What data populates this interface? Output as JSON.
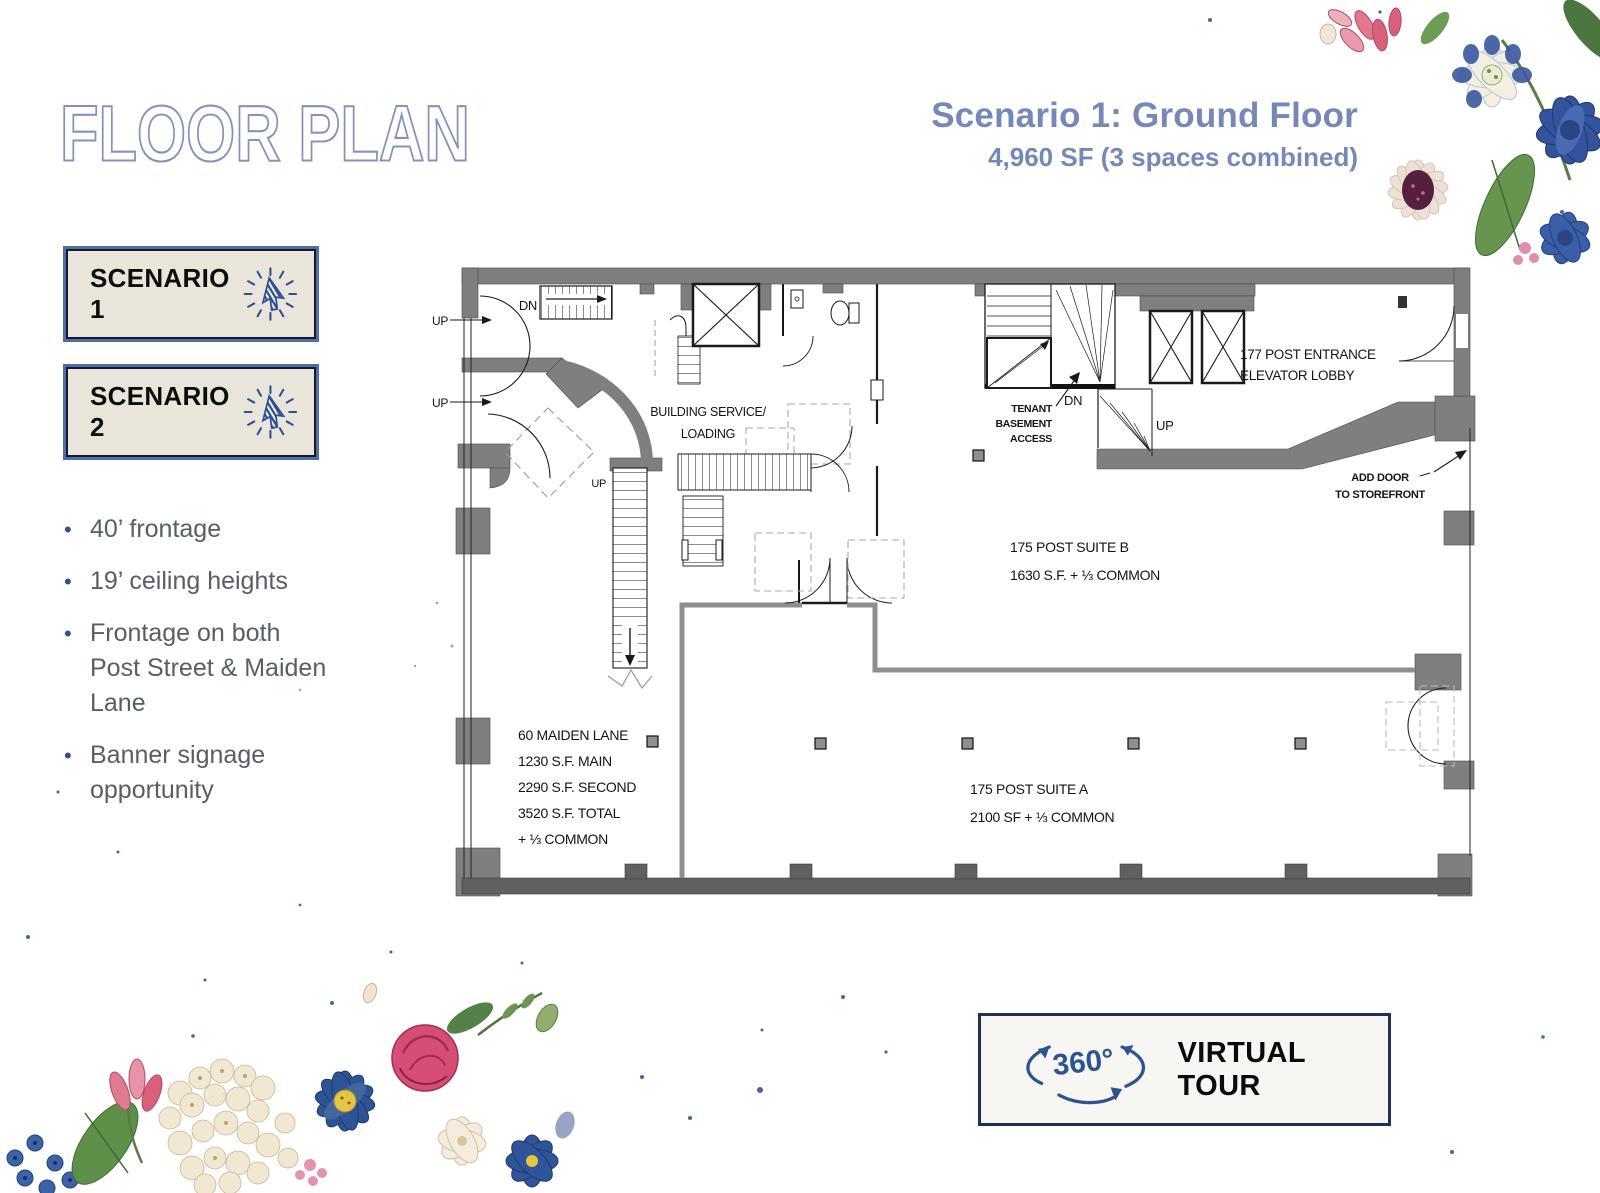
{
  "page": {
    "title": "FLOOR PLAN"
  },
  "header": {
    "scenario_title": "Scenario 1: Ground Floor",
    "scenario_subtitle": "4,960 SF (3 spaces combined)"
  },
  "sidebar": {
    "buttons": [
      {
        "label": "SCENARIO 1"
      },
      {
        "label": "SCENARIO 2"
      }
    ],
    "bullets": [
      "40’ frontage",
      "19’ ceiling heights",
      "Frontage on both Post Street & Maiden Lane",
      "Banner signage opportunity"
    ]
  },
  "floor_plan": {
    "stair_labels": {
      "dn_top": "DN",
      "up_left_1": "UP",
      "up_left_2": "UP",
      "up_mid": "UP",
      "dn_right": "DN",
      "up_right": "UP"
    },
    "rooms": {
      "building_service_line1": "BUILDING SERVICE/",
      "building_service_line2": "LOADING",
      "tenant_access_line1": "TENANT",
      "tenant_access_line2": "BASEMENT",
      "tenant_access_line3": "ACCESS",
      "entrance_line1": "177 POST ENTRANCE",
      "entrance_line2": "ELEVATOR LOBBY",
      "add_door_line1": "ADD DOOR",
      "add_door_line2": "TO STOREFRONT"
    },
    "suites": {
      "suite_b_name": "175 POST SUITE B",
      "suite_b_area": "1630 S.F. + ⅓ COMMON",
      "suite_a_name": "175 POST SUITE A",
      "suite_a_area": "2100 SF + ⅓ COMMON",
      "maiden_name": "60 MAIDEN LANE",
      "maiden_main": "1230 S.F. MAIN",
      "maiden_second": "2290 S.F. SECOND",
      "maiden_total": "3520 S.F. TOTAL",
      "maiden_common": "+ ⅓ COMMON"
    }
  },
  "footer": {
    "virtual_tour_label": "VIRTUAL TOUR",
    "virtual_tour_icon_text": "360°"
  },
  "colors": {
    "accent_blue": "#7588b7",
    "title_outline": "#8591bb",
    "button_bg": "#e9e5da",
    "button_border": "#4d6ea6",
    "icon_blue": "#2d4f92",
    "wall_gray": "#7f7f7f",
    "divider_gray": "#8f8f8f",
    "bullet_text": "#575e66",
    "tour_border": "#20305a"
  }
}
